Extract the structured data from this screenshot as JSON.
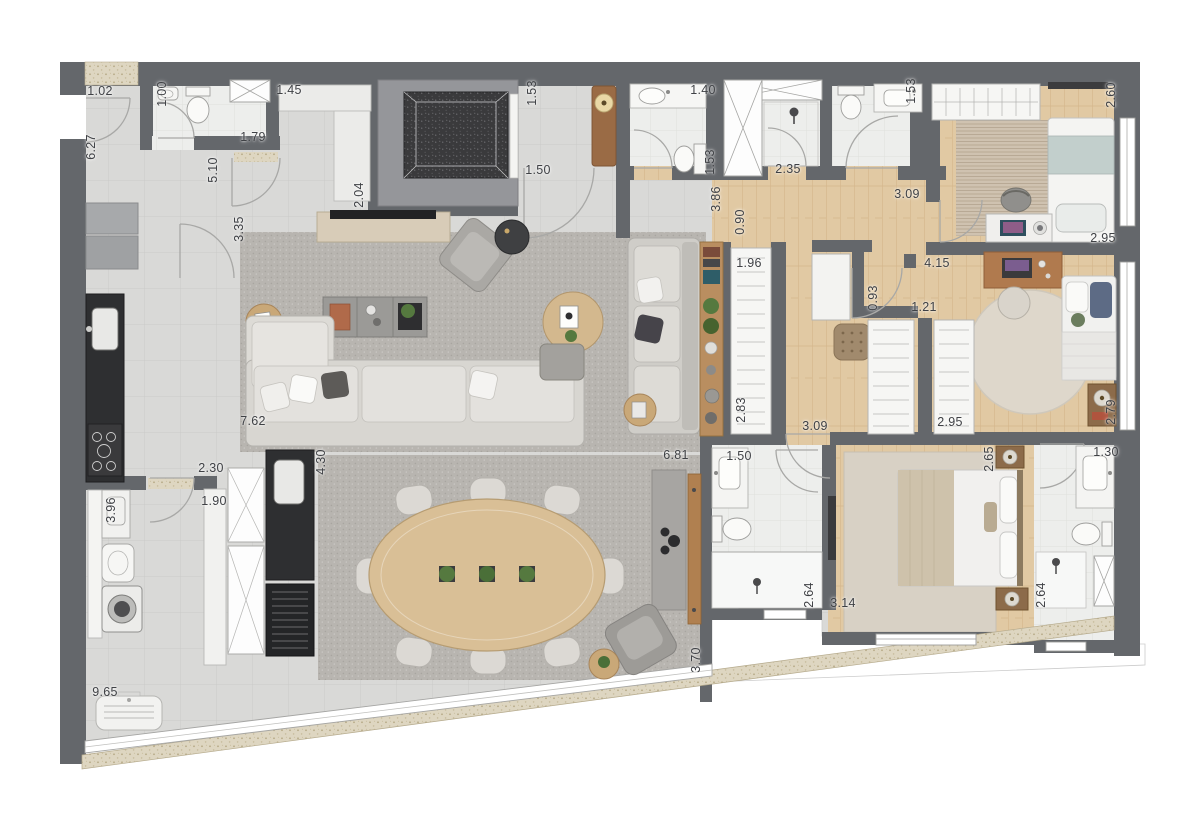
{
  "plan": {
    "dimension_labels": [
      {
        "text": "1.02",
        "x": 100,
        "y": 91,
        "rot": 0
      },
      {
        "text": "1.00",
        "x": 162,
        "y": 94,
        "rot": -90
      },
      {
        "text": "1.45",
        "x": 289,
        "y": 90,
        "rot": 0
      },
      {
        "text": "6.27",
        "x": 91,
        "y": 147,
        "rot": -90
      },
      {
        "text": "1.79",
        "x": 253,
        "y": 137,
        "rot": 0
      },
      {
        "text": "5.10",
        "x": 213,
        "y": 170,
        "rot": -90
      },
      {
        "text": "2.04",
        "x": 359,
        "y": 195,
        "rot": -90
      },
      {
        "text": "3.35",
        "x": 239,
        "y": 229,
        "rot": -90
      },
      {
        "text": "1.53",
        "x": 532,
        "y": 93,
        "rot": -90
      },
      {
        "text": "1.50",
        "x": 538,
        "y": 170,
        "rot": 0
      },
      {
        "text": "1.40",
        "x": 703,
        "y": 90,
        "rot": 0
      },
      {
        "text": "1.53",
        "x": 710,
        "y": 162,
        "rot": -90
      },
      {
        "text": "2.35",
        "x": 788,
        "y": 169,
        "rot": 0
      },
      {
        "text": "1.53",
        "x": 911,
        "y": 91,
        "rot": -90
      },
      {
        "text": "3.86",
        "x": 716,
        "y": 199,
        "rot": -90
      },
      {
        "text": "0.90",
        "x": 740,
        "y": 222,
        "rot": -90
      },
      {
        "text": "1.96",
        "x": 749,
        "y": 263,
        "rot": 0
      },
      {
        "text": "3.09",
        "x": 907,
        "y": 194,
        "rot": 0
      },
      {
        "text": "4.15",
        "x": 937,
        "y": 263,
        "rot": 0
      },
      {
        "text": "2.60",
        "x": 1111,
        "y": 95,
        "rot": -90
      },
      {
        "text": "2.95",
        "x": 1103,
        "y": 238,
        "rot": 0
      },
      {
        "text": "0.93",
        "x": 873,
        "y": 298,
        "rot": -90
      },
      {
        "text": "1.21",
        "x": 924,
        "y": 307,
        "rot": 0
      },
      {
        "text": "2.83",
        "x": 741,
        "y": 410,
        "rot": -90
      },
      {
        "text": "2.95",
        "x": 950,
        "y": 422,
        "rot": 0
      },
      {
        "text": "3.09",
        "x": 815,
        "y": 426,
        "rot": 0
      },
      {
        "text": "2.79",
        "x": 1111,
        "y": 412,
        "rot": -90
      },
      {
        "text": "7.62",
        "x": 253,
        "y": 421,
        "rot": 0
      },
      {
        "text": "2.30",
        "x": 211,
        "y": 468,
        "rot": 0
      },
      {
        "text": "1.90",
        "x": 214,
        "y": 501,
        "rot": 0
      },
      {
        "text": "4.30",
        "x": 321,
        "y": 462,
        "rot": -90
      },
      {
        "text": "3.96",
        "x": 111,
        "y": 510,
        "rot": -90
      },
      {
        "text": "6.81",
        "x": 676,
        "y": 455,
        "rot": 0
      },
      {
        "text": "1.50",
        "x": 739,
        "y": 456,
        "rot": 0
      },
      {
        "text": "2.65",
        "x": 989,
        "y": 459,
        "rot": -90
      },
      {
        "text": "1.30",
        "x": 1106,
        "y": 452,
        "rot": 0
      },
      {
        "text": "2.64",
        "x": 809,
        "y": 595,
        "rot": -90
      },
      {
        "text": "3.14",
        "x": 843,
        "y": 603,
        "rot": 0
      },
      {
        "text": "2.64",
        "x": 1041,
        "y": 595,
        "rot": -90
      },
      {
        "text": "3.70",
        "x": 696,
        "y": 660,
        "rot": -90
      },
      {
        "text": "9.65",
        "x": 105,
        "y": 692,
        "rot": 0
      }
    ],
    "palette": {
      "wall": "#64676b",
      "floor_tile": "#d9d9d7",
      "floor_wood": "#e1c9a3",
      "floor_bath": "#edeeec",
      "rug_gray": "#b8b5b0",
      "rug_bedroom": "#cfc2b0",
      "rug_round": "#ded7cb",
      "rug_master": "#d8d1c5",
      "counter_black": "#2e2f31",
      "granite_dark": "#3a3a3c",
      "parapet_beige": "#ded6c1",
      "furniture_wood": "#c9a878",
      "plant_green": "#55793f",
      "label_text": "#3f4145"
    }
  }
}
